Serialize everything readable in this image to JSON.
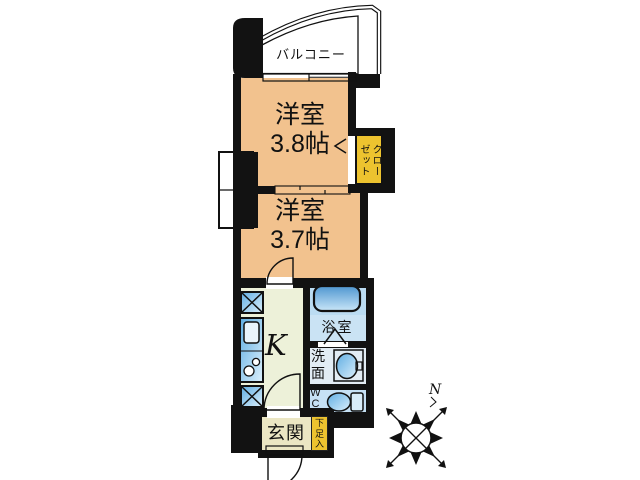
{
  "palette": {
    "wall": "#121212",
    "room_tan": "#F2C28E",
    "balcony_lav": "#CBCFE0",
    "gold": "#EDC32F",
    "kitchen_green": "#EDF1D9",
    "entrance_beige": "#EBE6C3",
    "ps_cream": "#F1F0DE",
    "bath_blue": "#BBDCF2",
    "bath_label_blue": "#CAE3F4",
    "wash_blue": "#E2ECF4",
    "wc_blue": "#C6E1F5"
  },
  "rooms": {
    "balcony": {
      "label": "バルコニー"
    },
    "room1": {
      "name": "洋室",
      "size": "3.8帖"
    },
    "room2": {
      "name": "洋室",
      "size": "3.7帖"
    },
    "closet": {
      "line1": "クロー",
      "line2": "ゼット"
    },
    "bath": {
      "label": "浴室"
    },
    "kitchen": {
      "label": "K"
    },
    "wash": {
      "line1": "洗",
      "line2": "面"
    },
    "wc": {
      "line1": "W",
      "line2": "C"
    },
    "entrance": {
      "label": "玄関"
    },
    "shoebox": {
      "line1": "下",
      "line2": "足",
      "line3": "入"
    },
    "compass": {
      "north": "N"
    }
  }
}
